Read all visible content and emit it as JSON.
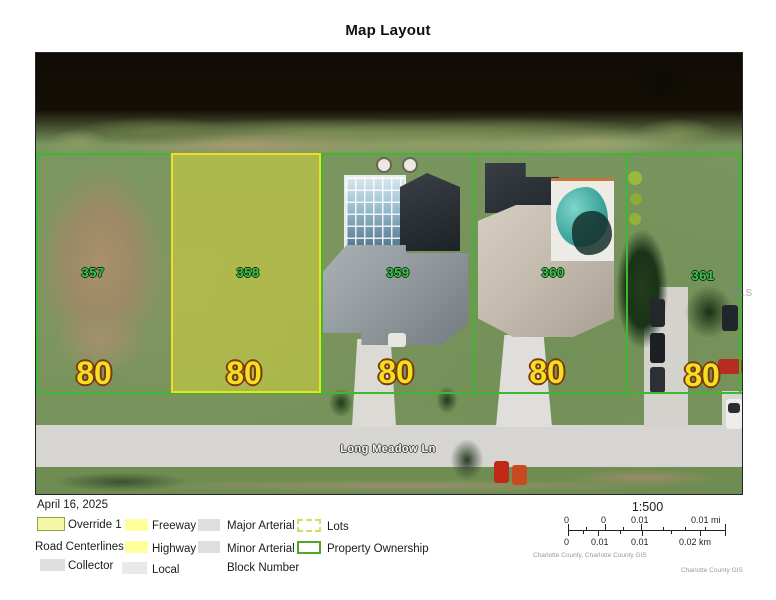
{
  "title": "Map Layout",
  "map": {
    "street_label": "Long Meadow Ln",
    "watermark": "MLS",
    "parcels": [
      {
        "id": "357",
        "frontage": "80"
      },
      {
        "id": "358",
        "frontage": "80",
        "highlighted": true
      },
      {
        "id": "359",
        "frontage": "80"
      },
      {
        "id": "360",
        "frontage": "80"
      },
      {
        "id": "361",
        "frontage": "80"
      }
    ]
  },
  "legend": {
    "date": "April 16, 2025",
    "items": [
      {
        "label": "Override 1",
        "swatch": "filled-outline"
      },
      {
        "label": "Freeway",
        "swatch": "yellow-fill"
      },
      {
        "label": "Major Arterial",
        "swatch": "gray-fill"
      },
      {
        "label": "Lots",
        "swatch": "dashed-outline"
      },
      {
        "label": "Road Centerlines",
        "swatch": "none"
      },
      {
        "label": "Highway",
        "swatch": "yellow-fill"
      },
      {
        "label": "Minor Arterial",
        "swatch": "gray-fill"
      },
      {
        "label": "Property Ownership",
        "swatch": "green-outline"
      },
      {
        "label": "Collector",
        "swatch": "gray-fill"
      },
      {
        "label": "Local",
        "swatch": "lightgray-fill"
      },
      {
        "label": "Block Number",
        "swatch": "none"
      }
    ]
  },
  "scalebar": {
    "ratio": "1:500",
    "mi": [
      "0",
      "0",
      "0.01",
      "0.01 mi"
    ],
    "km": [
      "0",
      "0.01",
      "0.01",
      "0.02 km"
    ],
    "credit_left": "Charlotte County, Charlotte County GIS",
    "credit_right": "Charlotte County GIS"
  },
  "colors": {
    "override_fill": "#f4ee30",
    "override_border": "#eee01e",
    "property_line": "#3cb832",
    "parcel_label": "#3ec44e",
    "frontage_label": "#f6de20",
    "legend_yellow": "#ffff9e",
    "legend_gray": "#dedede",
    "lots_dash": "#d2de60",
    "ownership_green": "#55a42c"
  }
}
